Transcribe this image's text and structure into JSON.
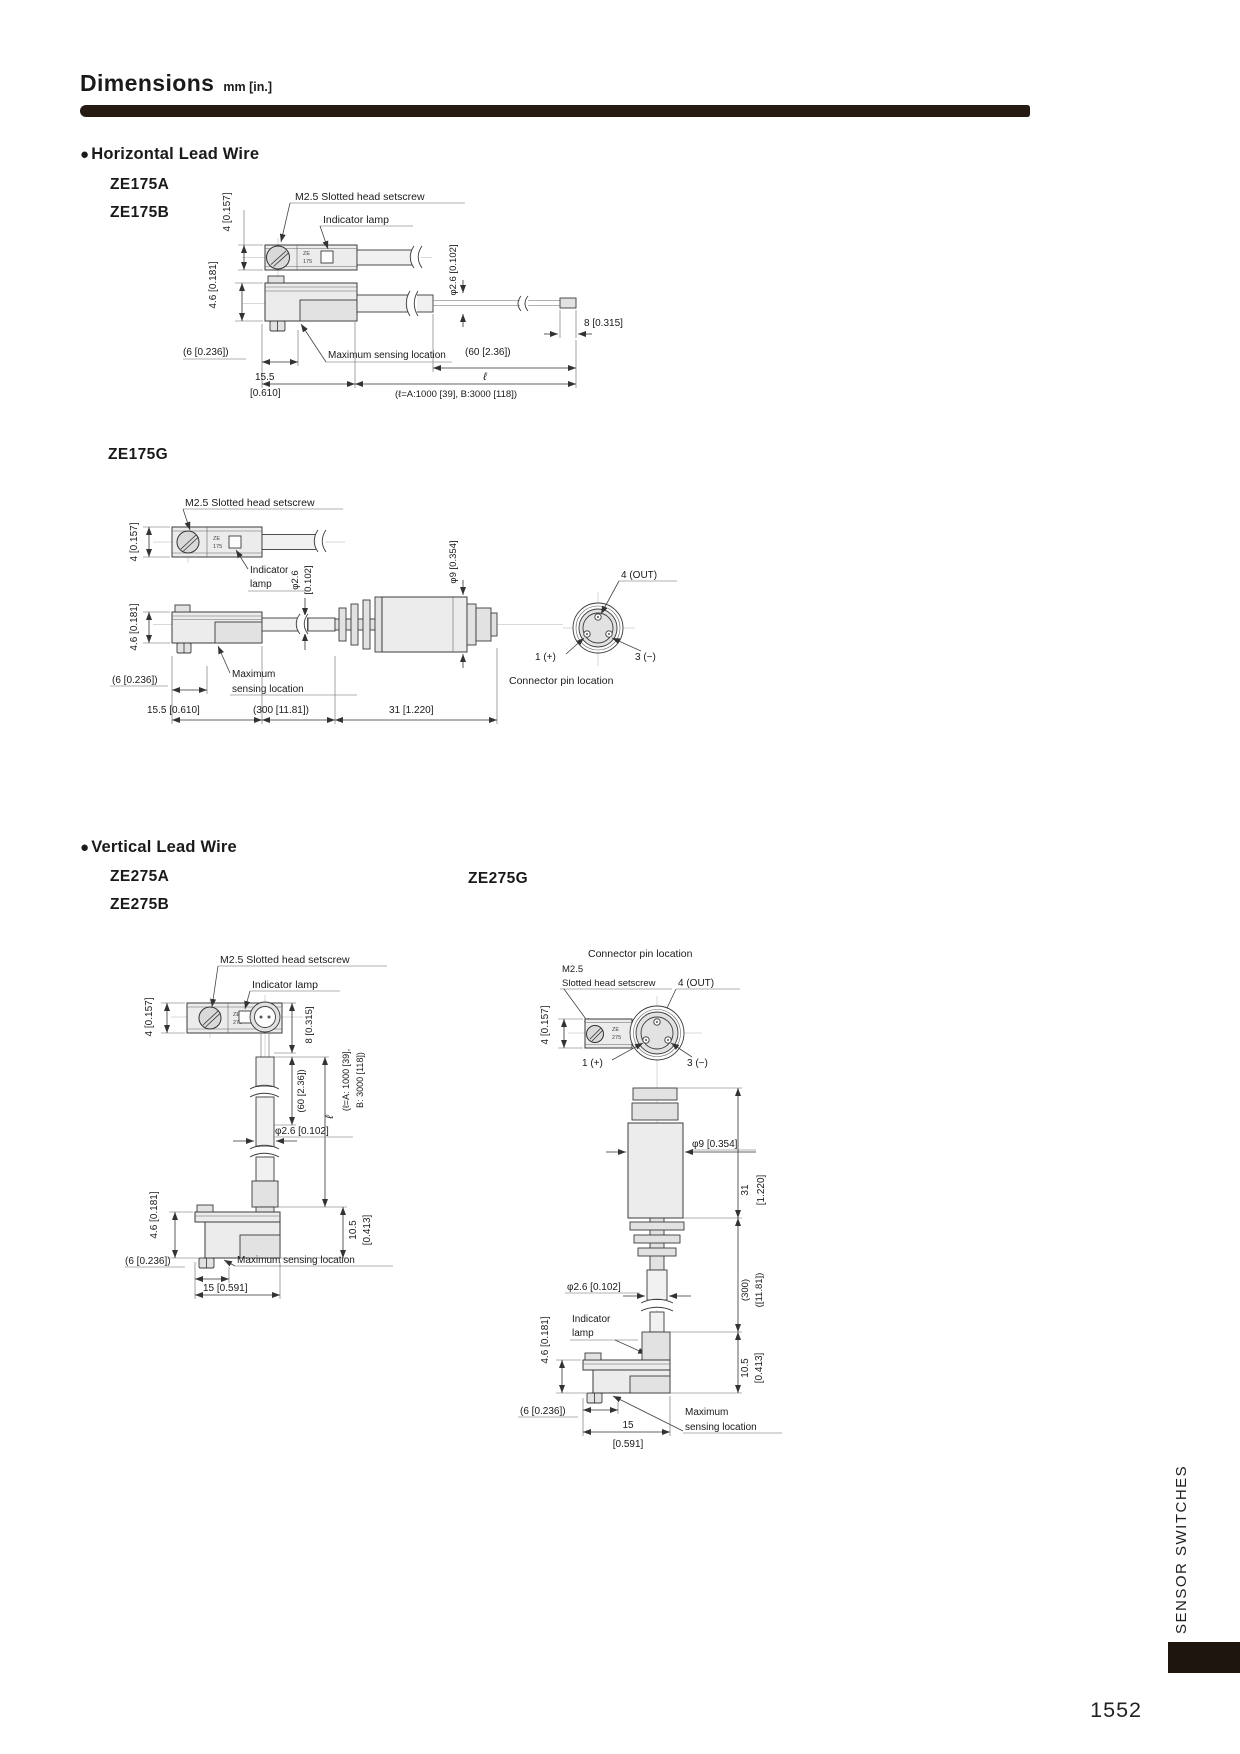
{
  "page": {
    "title": "Dimensions",
    "unit": "mm [in.]",
    "page_number": "1552",
    "side_tab": "SENSOR SWITCHES"
  },
  "sections": {
    "horizontal": {
      "heading": "Horizontal Lead Wire",
      "model_a": "ZE175A",
      "model_b": "ZE175B",
      "model_g": "ZE175G"
    },
    "vertical": {
      "heading": "Vertical Lead Wire",
      "model_a": "ZE275A",
      "model_b": "ZE275B",
      "model_g": "ZE275G"
    }
  },
  "labels": {
    "bullet": "●",
    "setscrew": "M2.5 Slotted head setscrew",
    "setscrew_m25": "M2.5",
    "setscrew_rest": "Slotted head setscrew",
    "indicator_lamp": "Indicator lamp",
    "indicator": "Indicator",
    "lamp": "lamp",
    "max_sensing": "Maximum sensing location",
    "maximum": "Maximum",
    "sensing_location": "sensing location",
    "connector_pin_location": "Connector pin location",
    "pin_1": "1 (+)",
    "pin_3": "3 (−)",
    "pin_4": "4 (OUT)",
    "tiny_ze": "ZE",
    "tiny_175": "175",
    "tiny_275": "275"
  },
  "dims": {
    "h4": "4 [0.157]",
    "h46": "4.6 [0.181]",
    "dia26": "φ2.6 [0.102]",
    "dia26_a": "φ2.6",
    "dia26_b": "[0.102]",
    "dia9": "φ9 [0.354]",
    "w6": "(6 [0.236])",
    "w8": "8 [0.315]",
    "w60": "(60 [2.36])",
    "w155_a": "15.5",
    "w155_b": "[0.610]",
    "w155": "15.5 [0.610]",
    "w300": "(300 [11.81])",
    "w300_a": "(300)",
    "w300_b": "([11.81])",
    "w31": "31 [1.220]",
    "w31_a": "31",
    "w31_b": "[1.220]",
    "w15": "15 [0.591]",
    "w15_a": "15",
    "w15_b": "[0.591]",
    "h105_a": "10.5",
    "h105_b": "[0.413]",
    "ell": "ℓ",
    "ell_def": "(ℓ=A:1000 [39], B:3000 [118])",
    "ell_def_a": "(ℓ=A: 1000 [39],",
    "ell_def_b": "B: 3000 [118])"
  }
}
